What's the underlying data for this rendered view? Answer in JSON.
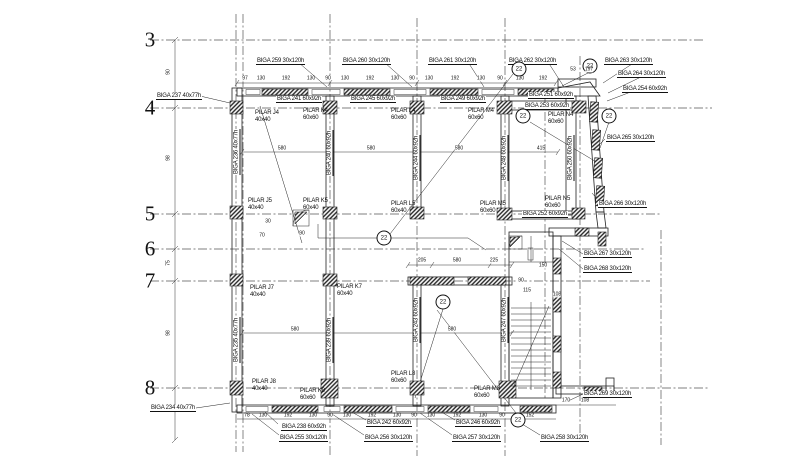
{
  "drawing": {
    "type_note": "structural floor framing plan",
    "ink": "#111111",
    "background": "#ffffff"
  },
  "grid": {
    "rows": [
      {
        "y": 40,
        "x1": 150,
        "x2": 705
      },
      {
        "y": 108,
        "x1": 150,
        "x2": 712
      },
      {
        "y": 214,
        "x1": 150,
        "x2": 662
      },
      {
        "y": 249,
        "x1": 150,
        "x2": 645
      },
      {
        "y": 281,
        "x1": 150,
        "x2": 650
      },
      {
        "y": 388,
        "x1": 150,
        "x2": 708
      }
    ],
    "cols": [
      {
        "x": 236,
        "y1": 14,
        "y2": 452
      },
      {
        "x": 243,
        "y1": 14,
        "y2": 452
      },
      {
        "x": 330,
        "y1": 14,
        "y2": 456
      },
      {
        "x": 417,
        "y1": 18,
        "y2": 456
      },
      {
        "x": 505,
        "y1": 18,
        "y2": 456
      },
      {
        "x": 545,
        "y1": 96,
        "y2": 400
      },
      {
        "x": 580,
        "y1": 56,
        "y2": 440
      },
      {
        "x": 661,
        "y1": 230,
        "y2": 445
      }
    ]
  },
  "row_labels": [
    {
      "t": "3",
      "x": 150,
      "y": 40
    },
    {
      "t": "4",
      "x": 150,
      "y": 108
    },
    {
      "t": "5",
      "x": 150,
      "y": 214
    },
    {
      "t": "6",
      "x": 150,
      "y": 249
    },
    {
      "t": "7",
      "x": 150,
      "y": 281
    },
    {
      "t": "8",
      "x": 150,
      "y": 388
    }
  ],
  "beam_labels": [
    {
      "t": "BIGA 259 30x120h",
      "x": 256,
      "y": 58
    },
    {
      "t": "BIGA 260 30x120h",
      "x": 342,
      "y": 58
    },
    {
      "t": "BIGA 261 30x120h",
      "x": 428,
      "y": 58
    },
    {
      "t": "BIGA 262 30x120h",
      "x": 508,
      "y": 58
    },
    {
      "t": "BIGA 263 30x120h",
      "x": 604,
      "y": 58
    },
    {
      "t": "BIGA 264 30x120h",
      "x": 617,
      "y": 71
    },
    {
      "t": "BIGA 254 60x92h",
      "x": 622,
      "y": 86
    },
    {
      "t": "BIGA 237 40x77h",
      "x": 156,
      "y": 93
    },
    {
      "t": "BIGA 241 60x92h",
      "x": 276,
      "y": 96
    },
    {
      "t": "BIGA 245 60x92h",
      "x": 350,
      "y": 96
    },
    {
      "t": "BIGA 249 60x92h",
      "x": 440,
      "y": 96
    },
    {
      "t": "BIGA 251 60x92h",
      "x": 528,
      "y": 92
    },
    {
      "t": "BIGA 253 60x92h",
      "x": 524,
      "y": 103
    },
    {
      "t": "BIGA 265 30x120h",
      "x": 606,
      "y": 135
    },
    {
      "t": "BIGA 266 30x120h",
      "x": 598,
      "y": 201
    },
    {
      "t": "BIGA 252 60x92h",
      "x": 522,
      "y": 211
    },
    {
      "t": "BIGA 267 30x120h",
      "x": 583,
      "y": 251
    },
    {
      "t": "BIGA 268 30x120h",
      "x": 583,
      "y": 266
    },
    {
      "t": "BIGA 234 40x77h",
      "x": 150,
      "y": 405
    },
    {
      "t": "BIGA 238 60x92h",
      "x": 281,
      "y": 424
    },
    {
      "t": "BIGA 255 30x120h",
      "x": 279,
      "y": 435
    },
    {
      "t": "BIGA 242 60x92h",
      "x": 366,
      "y": 420
    },
    {
      "t": "BIGA 256 30x120h",
      "x": 364,
      "y": 435
    },
    {
      "t": "BIGA 246 60x92h",
      "x": 455,
      "y": 420
    },
    {
      "t": "BIGA 257 30x120h",
      "x": 452,
      "y": 435
    },
    {
      "t": "BIGA 258 30x120h",
      "x": 540,
      "y": 435
    },
    {
      "t": "BIGA 269 30x120h",
      "x": 583,
      "y": 391
    }
  ],
  "vertical_beam_labels": [
    {
      "t": "BIGA 236 40x77h",
      "x": 237,
      "y": 152
    },
    {
      "t": "BIGA 240 60x92h",
      "x": 330,
      "y": 153
    },
    {
      "t": "BIGA 244 60x92h",
      "x": 417,
      "y": 158
    },
    {
      "t": "BIGA 248 60x92h",
      "x": 505,
      "y": 158
    },
    {
      "t": "BIGA 250 60x92h",
      "x": 571,
      "y": 158
    },
    {
      "t": "BIGA 235 40x77h",
      "x": 237,
      "y": 340
    },
    {
      "t": "BIGA 239 60x92h",
      "x": 330,
      "y": 340
    },
    {
      "t": "BIGA 243 60x92h",
      "x": 417,
      "y": 320
    },
    {
      "t": "BIGA 247 60x92h",
      "x": 505,
      "y": 320
    }
  ],
  "pillar_labels": [
    {
      "l1": "PILAR J4",
      "l2": "40x40",
      "x": 255,
      "y": 110
    },
    {
      "l1": "PILAR K4",
      "l2": "60x60",
      "x": 303,
      "y": 108
    },
    {
      "l1": "PILAR L4",
      "l2": "60x60",
      "x": 391,
      "y": 108
    },
    {
      "l1": "PILAR M4",
      "l2": "60x60",
      "x": 468,
      "y": 108
    },
    {
      "l1": "PILAR N4",
      "l2": "60x60",
      "x": 548,
      "y": 112
    },
    {
      "l1": "PILAR J5",
      "l2": "40x40",
      "x": 248,
      "y": 198
    },
    {
      "l1": "PILAR K5",
      "l2": "60x40",
      "x": 303,
      "y": 198
    },
    {
      "l1": "PILAR L5",
      "l2": "60x40",
      "x": 391,
      "y": 201
    },
    {
      "l1": "PILAR M5",
      "l2": "60x60",
      "x": 480,
      "y": 201
    },
    {
      "l1": "PILAR N5",
      "l2": "60x60",
      "x": 545,
      "y": 196
    },
    {
      "l1": "PILAR J7",
      "l2": "40x40",
      "x": 250,
      "y": 285
    },
    {
      "l1": "PILAR K7",
      "l2": "60x40",
      "x": 337,
      "y": 284
    },
    {
      "l1": "PILAR J8",
      "l2": "40x40",
      "x": 252,
      "y": 379
    },
    {
      "l1": "PILAR K8",
      "l2": "60x60",
      "x": 300,
      "y": 388
    },
    {
      "l1": "PILAR L8",
      "l2": "60x60",
      "x": 391,
      "y": 371
    },
    {
      "l1": "PILAR M8",
      "l2": "60x60",
      "x": 474,
      "y": 386
    }
  ],
  "markers": [
    {
      "t": "22",
      "x": 519,
      "y": 69
    },
    {
      "t": "22",
      "x": 590,
      "y": 66
    },
    {
      "t": "22",
      "x": 523,
      "y": 116
    },
    {
      "t": "22",
      "x": 609,
      "y": 116
    },
    {
      "t": "22",
      "x": 384,
      "y": 238
    },
    {
      "t": "22",
      "x": 443,
      "y": 302
    },
    {
      "t": "22",
      "x": 518,
      "y": 420
    }
  ],
  "dims": [
    {
      "t": "97",
      "x": 245,
      "y": 79
    },
    {
      "t": "130",
      "x": 261,
      "y": 79
    },
    {
      "t": "192",
      "x": 286,
      "y": 79
    },
    {
      "t": "130",
      "x": 311,
      "y": 79
    },
    {
      "t": "90",
      "x": 328,
      "y": 79
    },
    {
      "t": "130",
      "x": 345,
      "y": 79
    },
    {
      "t": "192",
      "x": 370,
      "y": 79
    },
    {
      "t": "130",
      "x": 395,
      "y": 79
    },
    {
      "t": "90",
      "x": 412,
      "y": 79
    },
    {
      "t": "130",
      "x": 429,
      "y": 79
    },
    {
      "t": "192",
      "x": 455,
      "y": 79
    },
    {
      "t": "130",
      "x": 481,
      "y": 79
    },
    {
      "t": "90",
      "x": 500,
      "y": 79
    },
    {
      "t": "130",
      "x": 520,
      "y": 79
    },
    {
      "t": "192",
      "x": 543,
      "y": 79
    },
    {
      "t": "53",
      "x": 573,
      "y": 70
    },
    {
      "t": "197",
      "x": 589,
      "y": 70
    },
    {
      "t": "580",
      "x": 282,
      "y": 149
    },
    {
      "t": "580",
      "x": 371,
      "y": 149
    },
    {
      "t": "580",
      "x": 459,
      "y": 149
    },
    {
      "t": "415",
      "x": 541,
      "y": 149
    },
    {
      "t": "30",
      "x": 268,
      "y": 222
    },
    {
      "t": "70",
      "x": 262,
      "y": 236
    },
    {
      "t": "90",
      "x": 302,
      "y": 234
    },
    {
      "t": "205",
      "x": 422,
      "y": 261
    },
    {
      "t": "580",
      "x": 457,
      "y": 261
    },
    {
      "t": "225",
      "x": 494,
      "y": 261
    },
    {
      "t": "90",
      "x": 521,
      "y": 281
    },
    {
      "t": "115",
      "x": 527,
      "y": 291
    },
    {
      "t": "150",
      "x": 543,
      "y": 266
    },
    {
      "t": "108",
      "x": 557,
      "y": 295
    },
    {
      "t": "580",
      "x": 295,
      "y": 330
    },
    {
      "t": "580",
      "x": 452,
      "y": 330
    },
    {
      "t": "78",
      "x": 247,
      "y": 416
    },
    {
      "t": "130",
      "x": 263,
      "y": 416
    },
    {
      "t": "192",
      "x": 288,
      "y": 416
    },
    {
      "t": "130",
      "x": 313,
      "y": 416
    },
    {
      "t": "90",
      "x": 330,
      "y": 416
    },
    {
      "t": "130",
      "x": 347,
      "y": 416
    },
    {
      "t": "192",
      "x": 372,
      "y": 416
    },
    {
      "t": "130",
      "x": 397,
      "y": 416
    },
    {
      "t": "90",
      "x": 414,
      "y": 416
    },
    {
      "t": "130",
      "x": 431,
      "y": 416
    },
    {
      "t": "192",
      "x": 457,
      "y": 416
    },
    {
      "t": "130",
      "x": 483,
      "y": 416
    },
    {
      "t": "90",
      "x": 502,
      "y": 416
    },
    {
      "t": "152",
      "x": 530,
      "y": 416
    },
    {
      "t": "170",
      "x": 566,
      "y": 401
    },
    {
      "t": "108",
      "x": 585,
      "y": 401
    },
    {
      "t": "90",
      "x": 169,
      "y": 72,
      "rot": 1
    },
    {
      "t": "98",
      "x": 169,
      "y": 158,
      "rot": 1
    },
    {
      "t": "75",
      "x": 169,
      "y": 263,
      "rot": 1
    },
    {
      "t": "98",
      "x": 169,
      "y": 333,
      "rot": 1
    }
  ]
}
